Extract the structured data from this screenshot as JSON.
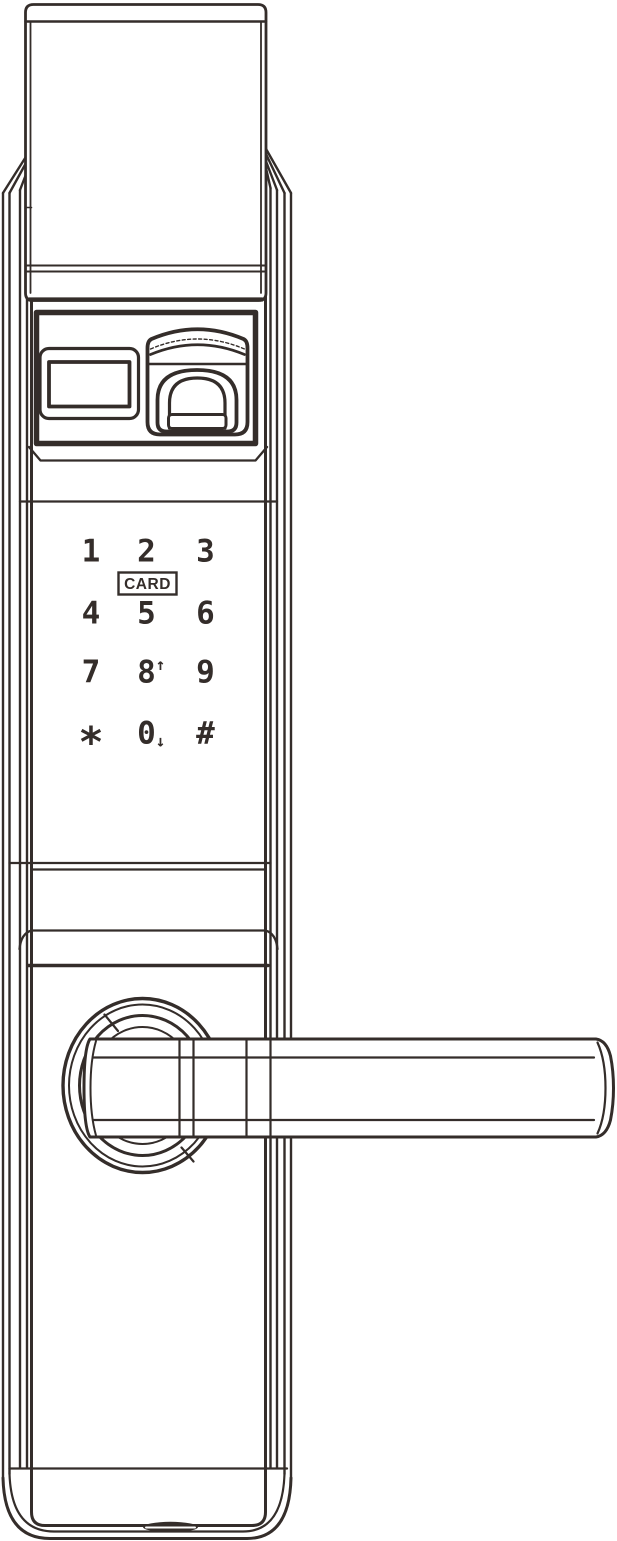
{
  "lock": {
    "colors": {
      "line": "#342d2a",
      "background": "#ffffff"
    },
    "card_reader": {
      "label": "CARD"
    },
    "keypad": {
      "keys": [
        {
          "label": "1"
        },
        {
          "label": "2"
        },
        {
          "label": "3"
        },
        {
          "label": "4"
        },
        {
          "label": "5"
        },
        {
          "label": "6"
        },
        {
          "label": "7"
        },
        {
          "label": "8",
          "arrow": "↑"
        },
        {
          "label": "9"
        },
        {
          "label": "*"
        },
        {
          "label": "0",
          "arrow": "↓"
        },
        {
          "label": "#"
        }
      ]
    }
  }
}
